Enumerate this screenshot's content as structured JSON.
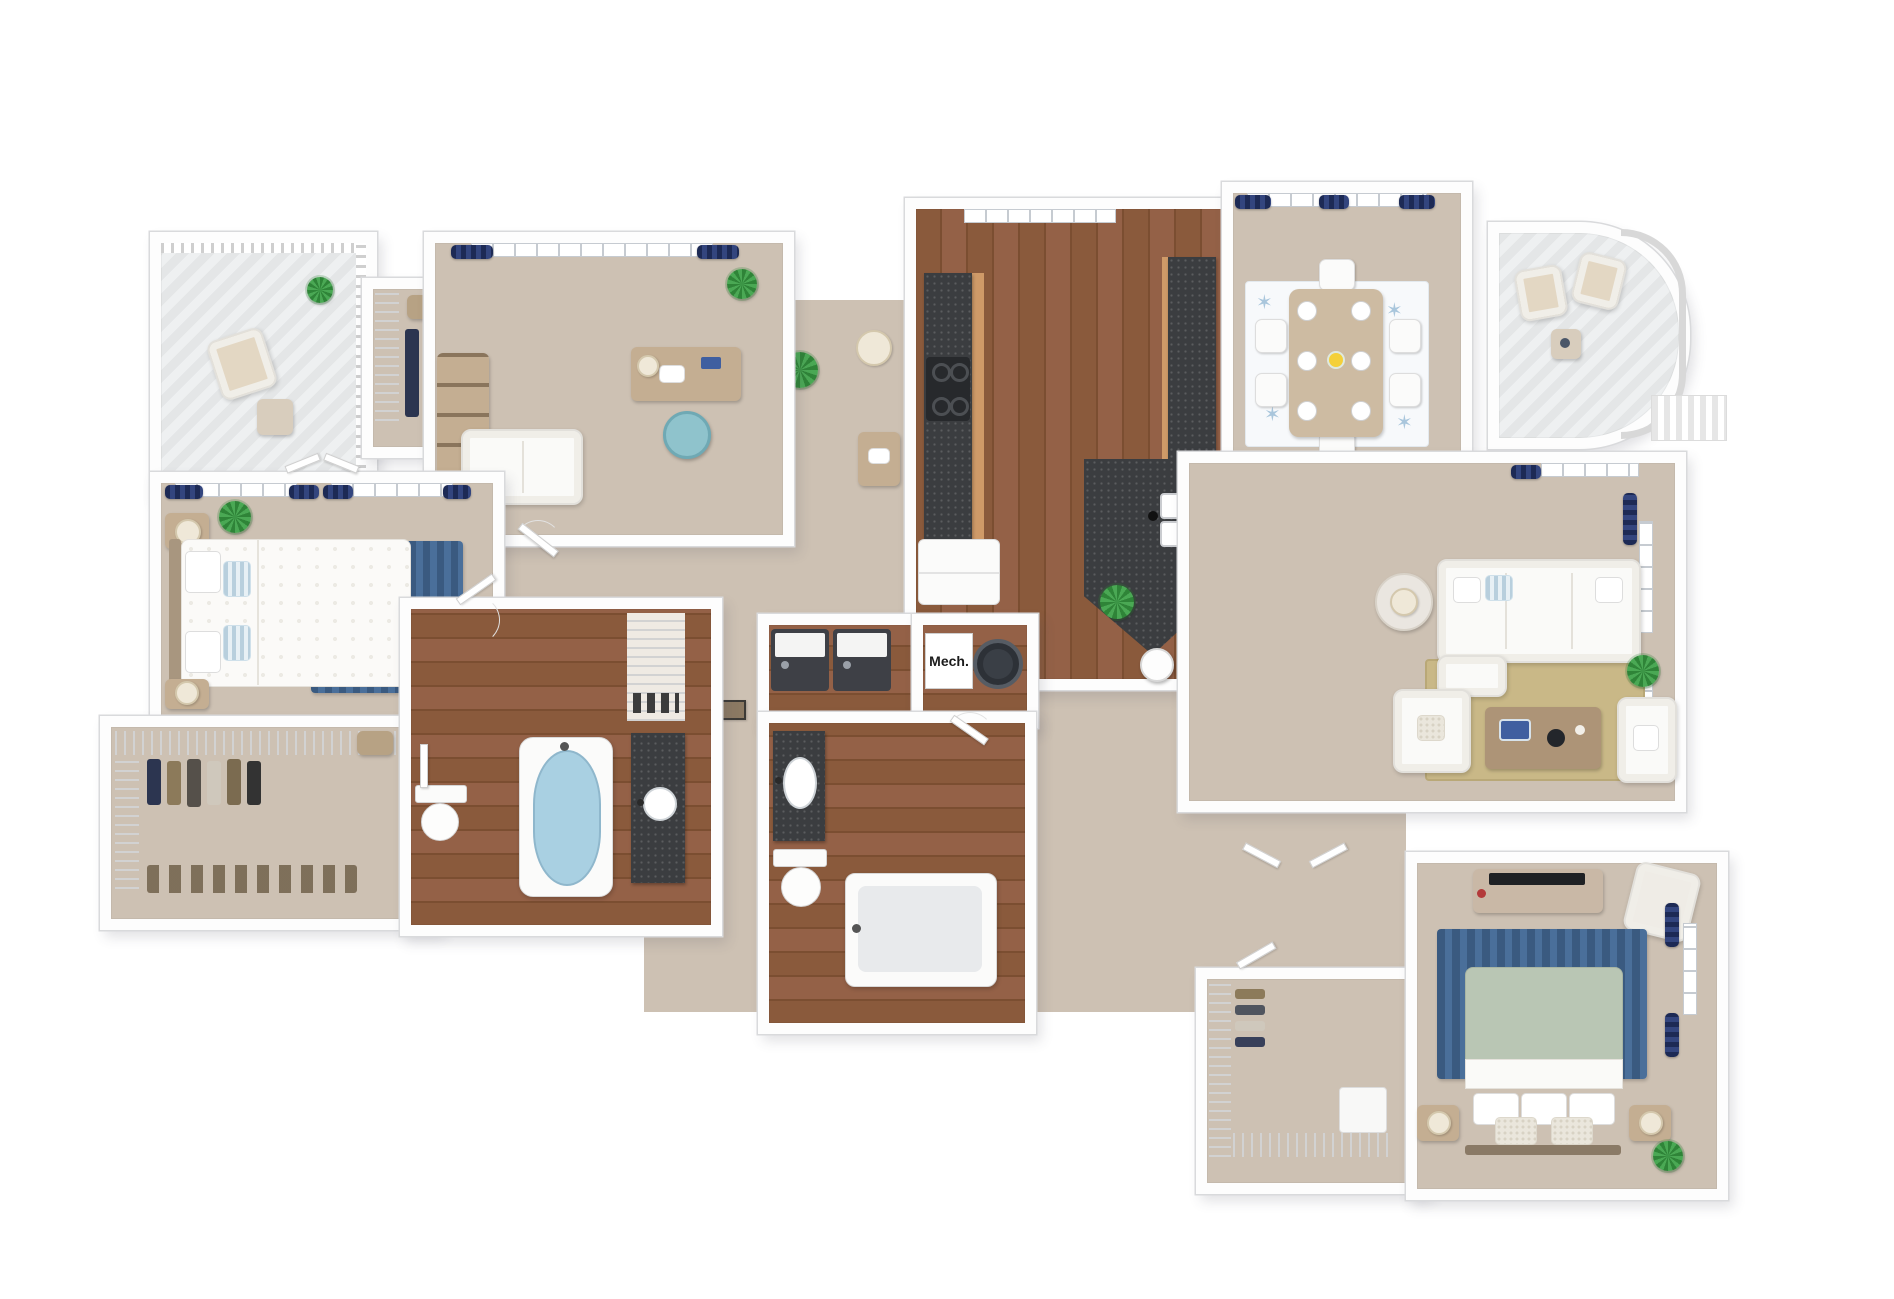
{
  "scene": {
    "type": "3d-floor-plan-rendering",
    "background": "#ffffff"
  },
  "labels": {
    "mech_room": "Mech."
  },
  "palette": {
    "wall": "#fdfdfd",
    "wall_edge": "#d9dadc",
    "carpet": "#cdc1b3",
    "wood_light": "#946147",
    "wood_dark": "#7b4e31",
    "granite": "#3b3d40",
    "cabinet_wood": "#cf9a68",
    "curtain_navy_dark": "#1d2a55",
    "curtain_navy_light": "#33457e",
    "rug_blue": "#40618a",
    "rug_jute": "#c9b887",
    "rug_dining": "#f7f9fb",
    "sofa_white": "#fafaf8",
    "accent_teal": "#8fc3cc",
    "blanket_sage": "#b9c6b4",
    "tub_water_blue": "#a9d0e2",
    "plant_green": "#3e9347",
    "table_wood": "#c4ae92"
  },
  "rooms": [
    {
      "id": "balcony-top-left",
      "floor": "deck",
      "items": [
        "patio-chair",
        "patio-side-table",
        "potted-plant",
        "railing"
      ]
    },
    {
      "id": "entry-closet",
      "floor": "carpet",
      "items": [
        "wire-shelving",
        "hanging-clothes",
        "storage-basket"
      ]
    },
    {
      "id": "home-office",
      "floor": "carpet",
      "items": [
        "window",
        "navy-curtains",
        "desk",
        "desk-chair",
        "bookshelf",
        "loveseat",
        "potted-plant"
      ]
    },
    {
      "id": "master-bedroom",
      "floor": "carpet",
      "items": [
        "french-door-windows",
        "navy-curtains",
        "queen-bed",
        "pillows",
        "nightstands",
        "table-lamps",
        "area-rug-blue",
        "potted-plant"
      ]
    },
    {
      "id": "master-closet",
      "floor": "carpet",
      "items": [
        "wire-shelving",
        "hanging-clothes",
        "shoe-rack",
        "storage-basket"
      ]
    },
    {
      "id": "master-bathroom",
      "floor": "hardwood",
      "items": [
        "vanity-vessel-sink",
        "soaking-tub",
        "toilet",
        "linen-closet"
      ]
    },
    {
      "id": "kitchen",
      "floor": "hardwood",
      "items": [
        "window",
        "range-stove",
        "counter-run-left",
        "counter-run-right",
        "refrigerator",
        "granite-island",
        "double-sink",
        "faucet",
        "bar-stools",
        "potted-plant"
      ]
    },
    {
      "id": "dining-room",
      "floor": "carpet",
      "items": [
        "window",
        "navy-curtains",
        "dining-table",
        "dining-chairs",
        "place-settings",
        "starfish-rug",
        "centerpiece-flowers"
      ]
    },
    {
      "id": "balcony-curved",
      "floor": "deck",
      "items": [
        "patio-chairs",
        "patio-side-table",
        "curved-railing"
      ]
    },
    {
      "id": "living-room",
      "floor": "carpet",
      "items": [
        "corner-windows",
        "navy-curtains",
        "sectional-sofa",
        "accent-pillows",
        "round-side-table",
        "table-lamp",
        "armchairs",
        "coffee-table",
        "books",
        "jute-rug",
        "potted-plant"
      ]
    },
    {
      "id": "laundry-closet",
      "floor": "hardwood",
      "items": [
        "washer",
        "dryer"
      ]
    },
    {
      "id": "mechanical-closet",
      "floor": "hardwood",
      "label_ref": "labels.mech_room",
      "items": [
        "water-heater"
      ]
    },
    {
      "id": "second-bathroom",
      "floor": "hardwood",
      "items": [
        "vanity-sink",
        "toilet",
        "bathtub"
      ]
    },
    {
      "id": "second-closet",
      "floor": "carpet",
      "items": [
        "wire-shelving",
        "hanging-clothes",
        "dresser"
      ]
    },
    {
      "id": "second-bedroom",
      "floor": "carpet",
      "items": [
        "dresser-tv-stand",
        "accent-chair",
        "area-rug-blue",
        "queen-bed",
        "sage-blanket",
        "pillows",
        "nightstands",
        "table-lamps",
        "windows",
        "navy-curtains",
        "potted-plant"
      ]
    },
    {
      "id": "hallway",
      "floor": "carpet",
      "items": [
        "wall-art-frames",
        "interior-doors"
      ]
    }
  ]
}
